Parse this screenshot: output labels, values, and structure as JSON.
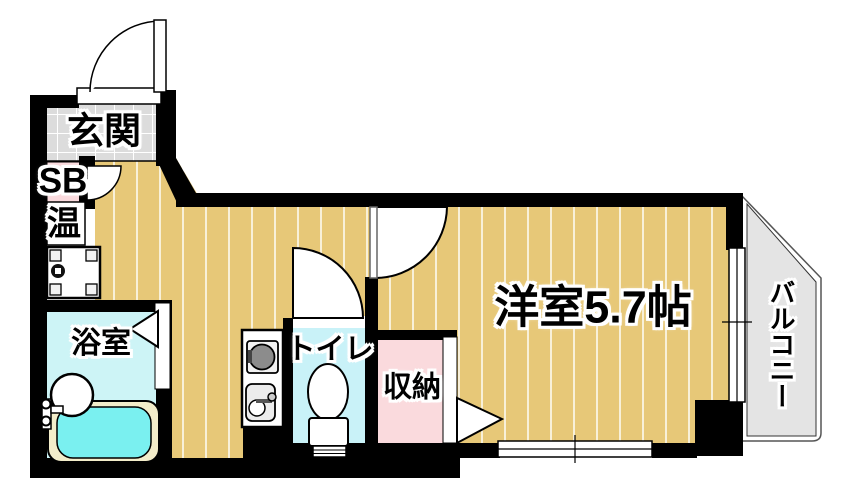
{
  "floor_plan": {
    "type": "apartment-floor-plan",
    "rooms": {
      "entrance": {
        "label": "玄関"
      },
      "shoe_box": {
        "label": "SB"
      },
      "water_heater": {
        "label": "温"
      },
      "bathroom": {
        "label": "浴室"
      },
      "toilet": {
        "label": "トイレ"
      },
      "storage": {
        "label": "収納"
      },
      "western_room": {
        "label": "洋室5.7帖",
        "size_tatami": 5.7
      },
      "balcony": {
        "label": "バルコニー"
      }
    },
    "colors": {
      "wall": "#000000",
      "floor_tan": "#e7c878",
      "floor_stripe": "#f8f0d8",
      "entrance_tile": "#dcdcdc",
      "pink": "#fadadd",
      "bathroom_cyan": "#cdf4f6",
      "toilet_cyan": "#c9f2f8",
      "bathtub_water": "#7af0f0",
      "bathtub_rim": "#f3edca",
      "balcony_gray": "#e4e4e4",
      "stove_gray": "#8c8c8c",
      "sink_gray": "#ececec"
    }
  }
}
